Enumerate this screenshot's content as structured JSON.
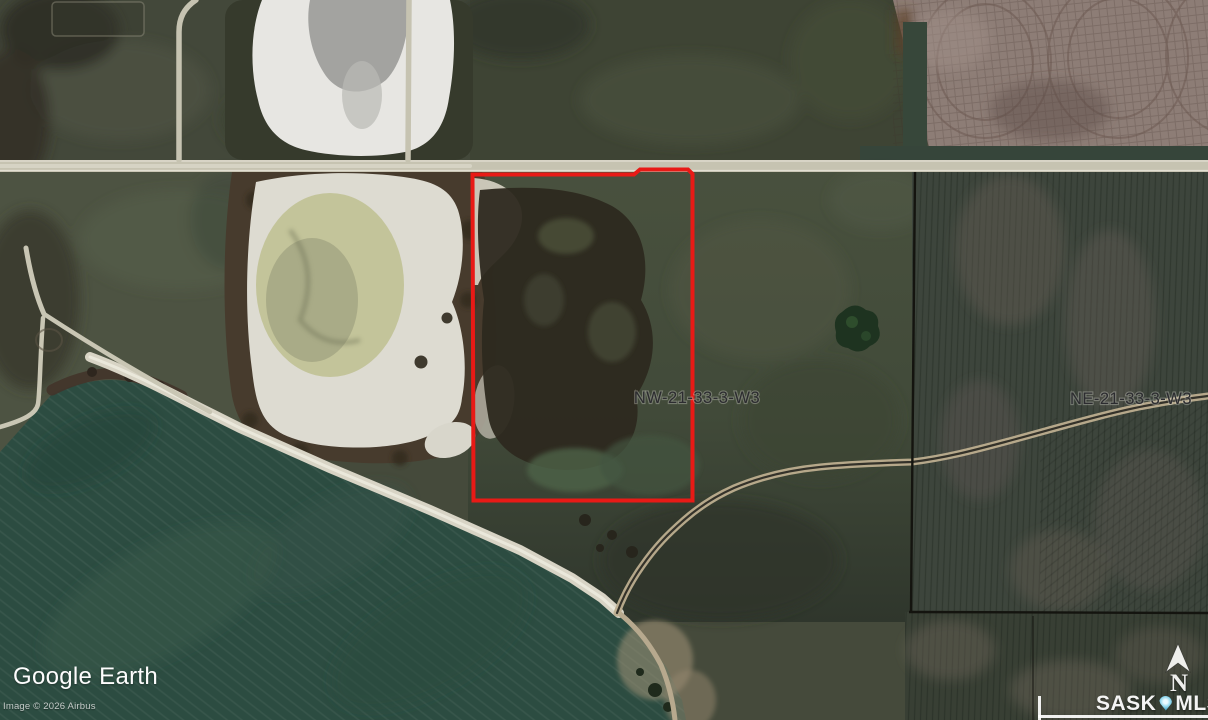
{
  "map": {
    "type": "satellite-aerial",
    "parcels": [
      {
        "id": "NW",
        "label": "NW-21-33-3-W3",
        "highlighted": true,
        "boundary_color": "#e81a16"
      },
      {
        "id": "NE",
        "label": "NE-21-33-3-W3",
        "highlighted": false
      }
    ]
  },
  "watermarks": {
    "google_earth_label": "Google Earth",
    "imagery_credit": "Image © 2026 Airbus",
    "listing_brand": {
      "prefix": "SASK",
      "suffix": "MLS",
      "registered": "®"
    }
  },
  "compass": {
    "north_label": "N"
  },
  "colors": {
    "parcel_boundary": "#e81a16",
    "lake": "#2c4c41",
    "road": "#c7c4b2",
    "watermark_text": "#ffffff",
    "pin_icon": "#8fd6ec"
  }
}
